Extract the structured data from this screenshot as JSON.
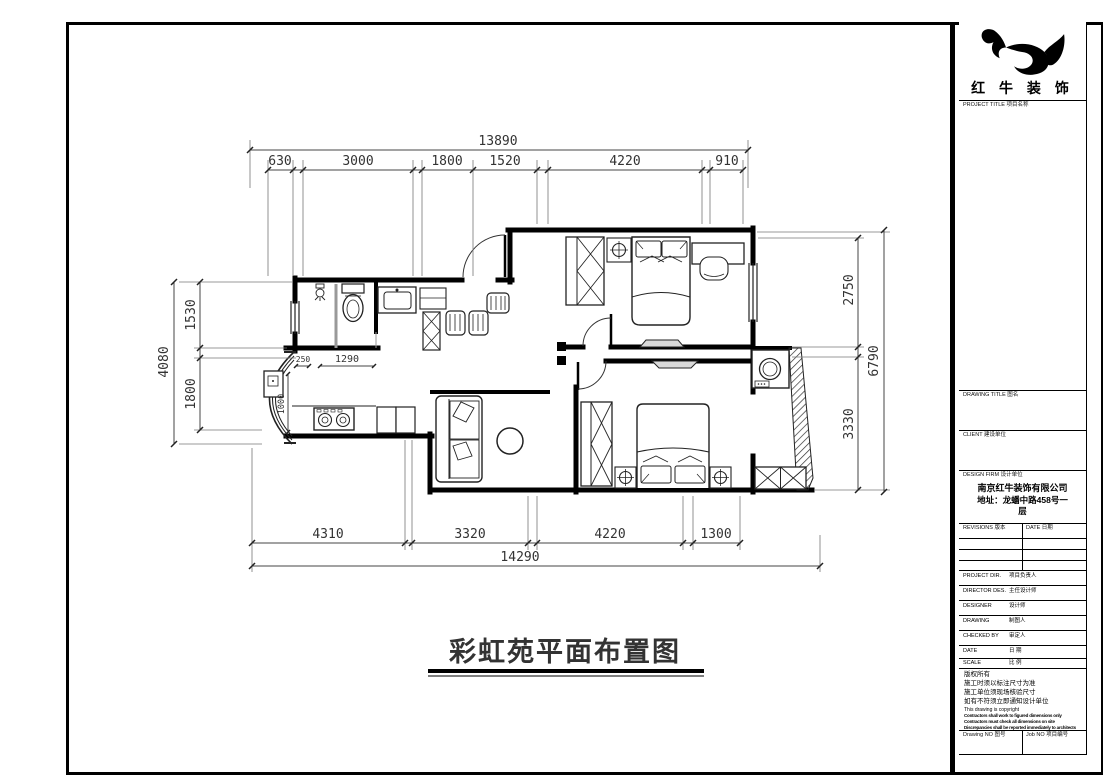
{
  "plan": {
    "title": "彩虹苑平面布置图",
    "dims": {
      "top_overall": "13890",
      "top": [
        "630",
        "3000",
        "1800",
        "1520",
        "4220",
        "910"
      ],
      "bottom": [
        "4310",
        "3320",
        "4220",
        "1300"
      ],
      "bottom_overall": "14290",
      "left_overall": "4080",
      "left": [
        "1530",
        "1800"
      ],
      "right": [
        "2750",
        "3330"
      ],
      "right_overall": "6790",
      "inner": [
        "250",
        "1290",
        "1000"
      ]
    }
  },
  "title_block": {
    "logo_icon": "bull-logo",
    "company_name": "红 牛 装 饰",
    "sections": {
      "project_title": "PROJECT TITLE  项目名称",
      "drawing_title": "DRAWING TITLE  图名",
      "client": "CLIENT  建设单位",
      "design_firm": "DESIGN FIRM  设计单位"
    },
    "firm": {
      "name": "南京红牛装饰有限公司",
      "address_line1": "地址：龙蟠中路458号一",
      "address_line2": "层"
    },
    "revisions": {
      "header_left": "REVISIONS  版本",
      "header_right": "DATE  日期"
    },
    "rows": [
      {
        "en": "PROJECT DIR.",
        "cn": "项目负责人"
      },
      {
        "en": "DIRECTOR DES.",
        "cn": "主任设计师"
      },
      {
        "en": "DESIGNER",
        "cn": "设计师"
      },
      {
        "en": "DRAWING",
        "cn": "制图人"
      },
      {
        "en": "CHECKED BY",
        "cn": "审定人"
      },
      {
        "en": "DATE",
        "cn": "日 期"
      },
      {
        "en": "SCALE",
        "cn": "比 例"
      }
    ],
    "notes": {
      "cn1": "版权所有",
      "cn2": "施工时须以标注尺寸为准",
      "cn3": "施工单位须现场核验尺寸",
      "cn4": "如有不符须立即通知设计单位",
      "en_copyright": "This drawing is copyright",
      "bold1": "Contractors shall work to figured dimensions only",
      "bold2": "Contractors must check all dimensions on site",
      "bold3": "Discrepancies shall be reported immediately to architects"
    },
    "footer": {
      "drawing_no": "Drawing NO  图号",
      "job_no": "Job NO  项目编号"
    }
  },
  "colors": {
    "line": "#000000",
    "dim_text": "#333333",
    "partition_gray": "#999999"
  }
}
